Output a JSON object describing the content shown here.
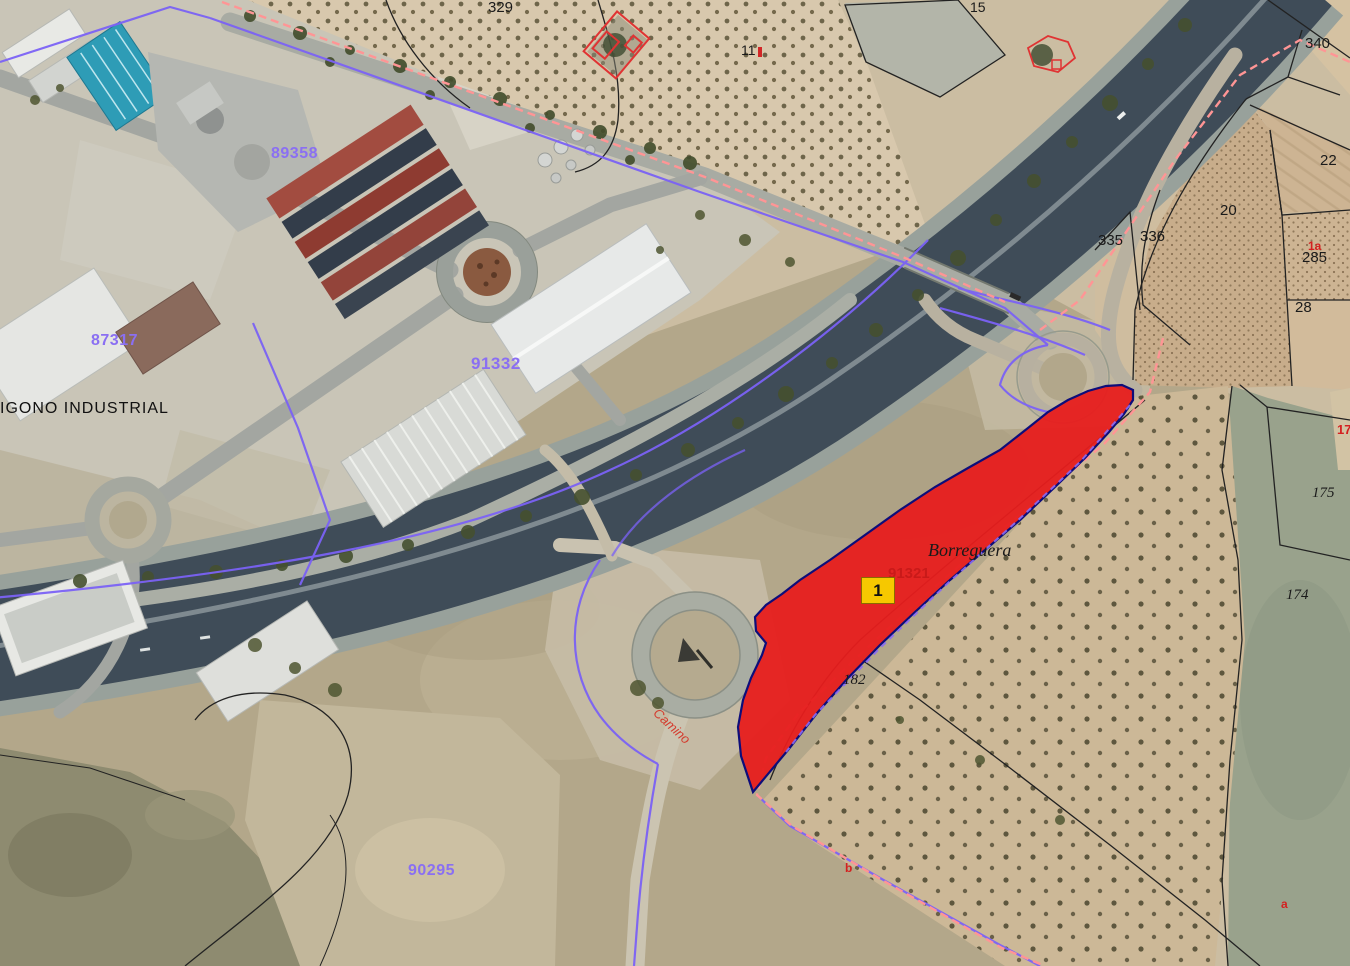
{
  "map": {
    "place_labels": {
      "industrial_estate": "IGONO INDUSTRIAL",
      "borreguera": "Borreguera",
      "camino": "Camino"
    },
    "cadastral_codes": {
      "c89358": "89358",
      "c87317": "87317",
      "c91332": "91332",
      "c90295": "90295",
      "c91321": "91321"
    },
    "parcel_numbers": {
      "p329": "329",
      "p15": "15",
      "p11": "11",
      "p340": "340",
      "p22": "22",
      "p20": "20",
      "p335": "335",
      "p336": "336",
      "p285": "285",
      "p28": "28",
      "p175": "175",
      "p174": "174",
      "p182": "182"
    },
    "subparcel_letters": {
      "tr_1a": "1a",
      "right_17": "17",
      "bottom_b": "b",
      "bottom_right_a": "a"
    },
    "selected_parcel": {
      "marker_label": "1"
    },
    "colors": {
      "selected_fill": "#e71d1d",
      "selected_border": "#0d0d7a",
      "marker_bg": "#f6c800",
      "boundary_purple": "#7b62f5",
      "boundary_pink": "#ff9595",
      "parcel_line": "#222222",
      "code_text": "#8a6ff2",
      "annotation_red": "#d42020"
    }
  }
}
